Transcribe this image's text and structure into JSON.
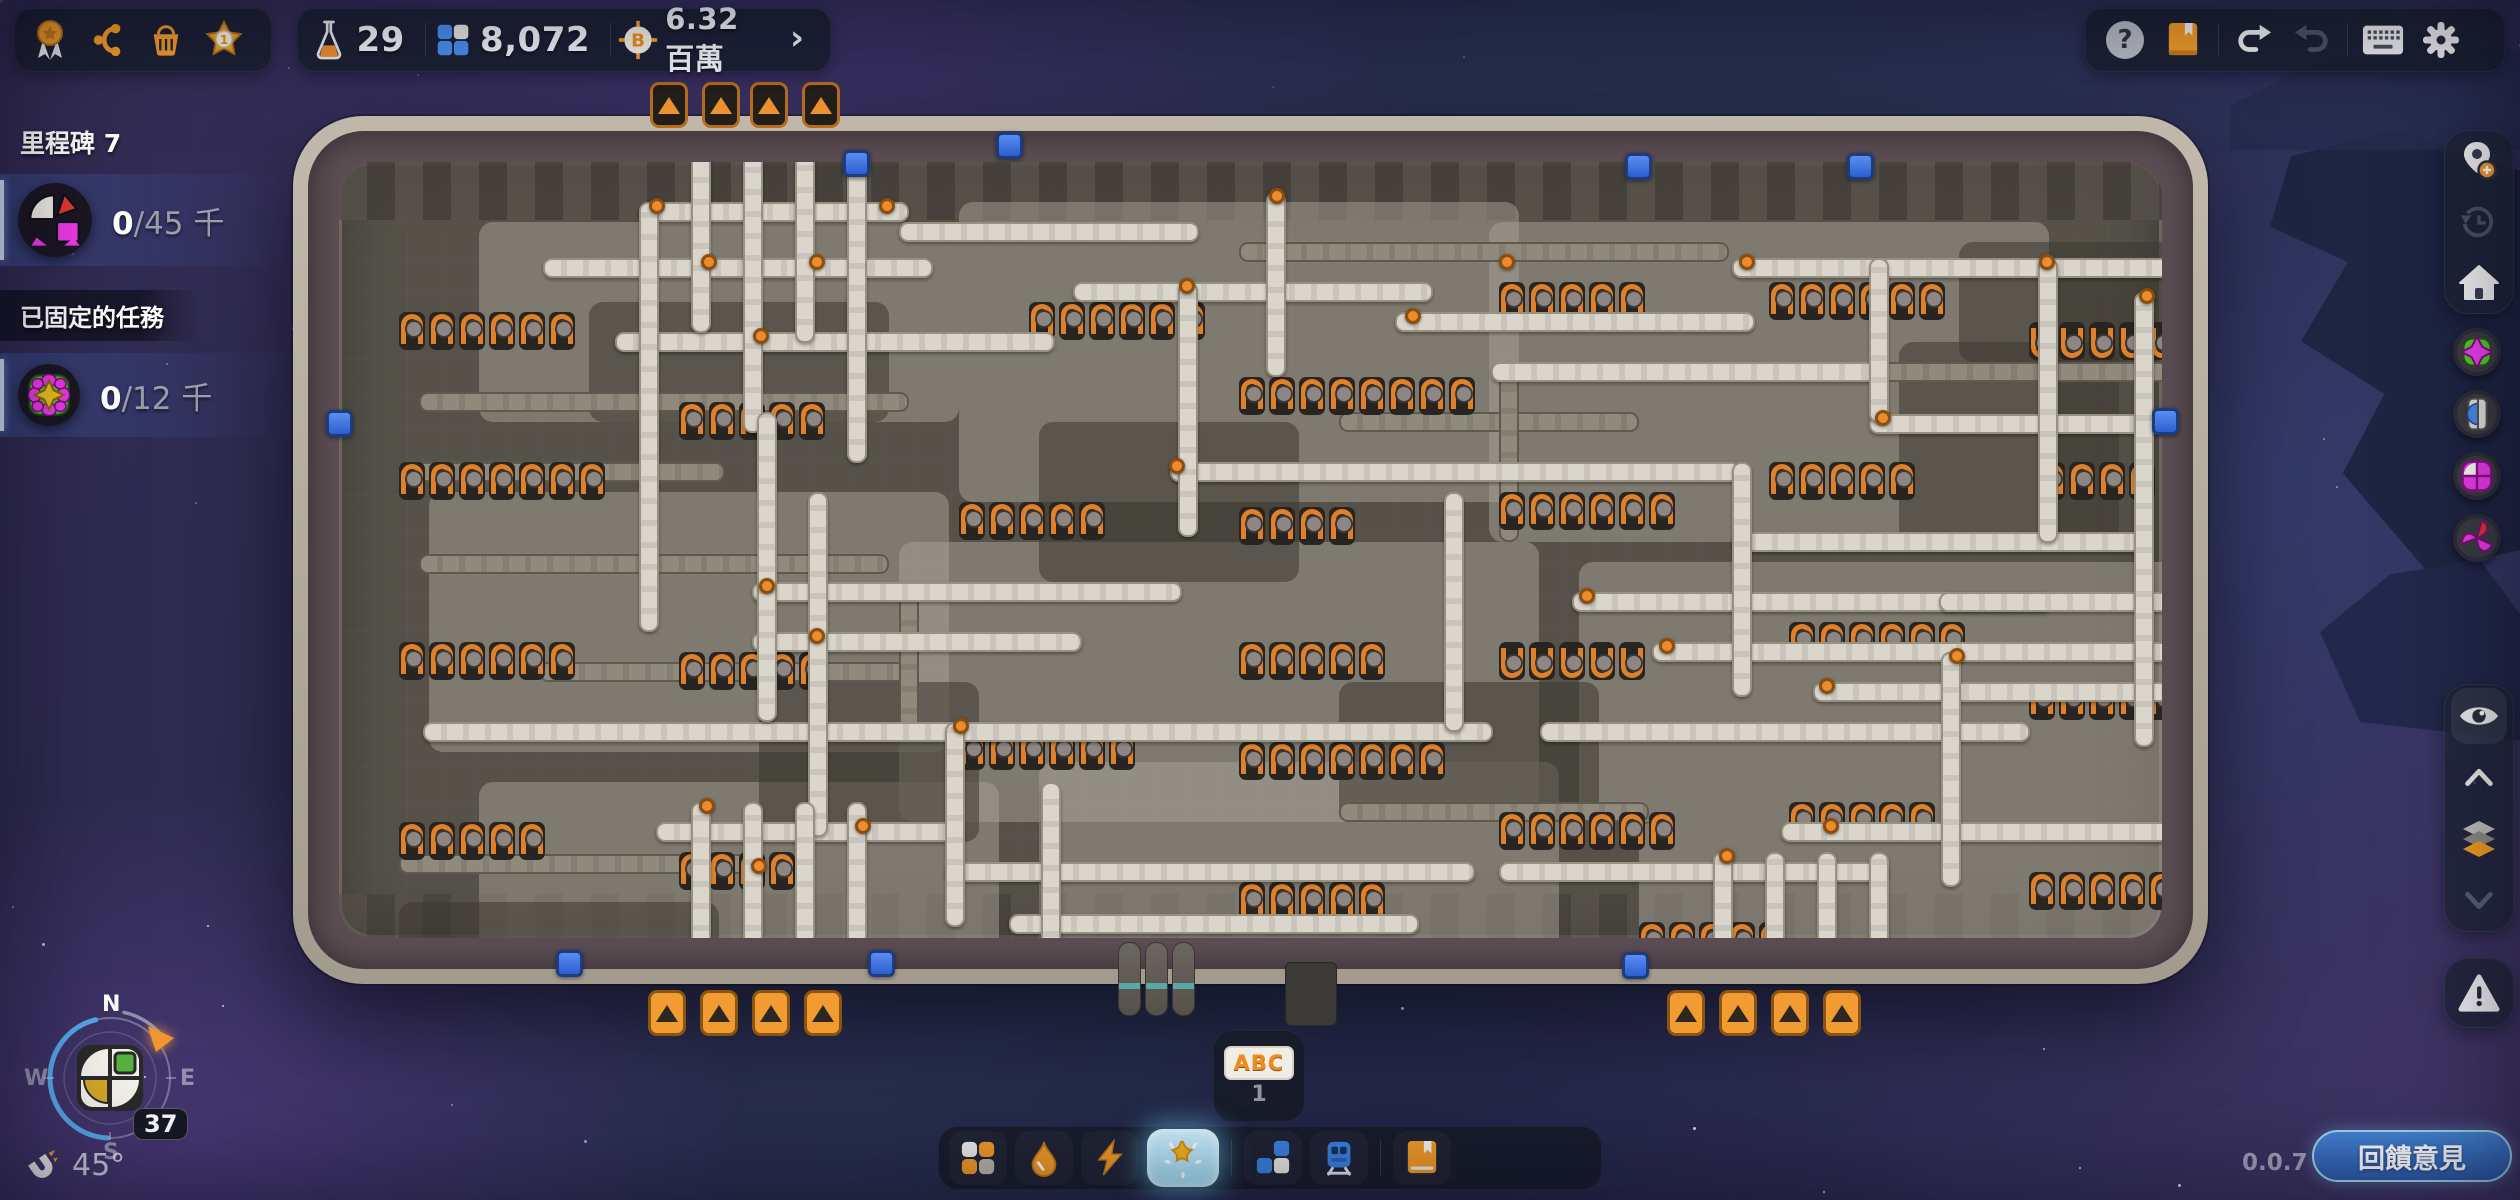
{
  "topbar": {
    "left_menu_icons": [
      "medal-icon",
      "milestones-curve-icon",
      "shop-basket-icon",
      "level-star-icon"
    ],
    "resources": {
      "research_points": "29",
      "stored_shapes": "8,072",
      "currency": "6.32 百萬",
      "expand_chevron": "›"
    },
    "system_icons": [
      "help-icon",
      "wiki-book-icon",
      "undo-icon",
      "redo-icon",
      "keyboard-icon",
      "settings-gear-icon"
    ]
  },
  "left_panel": {
    "milestone_title": "里程碑 7",
    "milestone": {
      "progress": "0",
      "goal": "/45 千"
    },
    "pinned_title": "已固定的任務",
    "pinned_task": {
      "progress": "0",
      "goal": "/12 千"
    }
  },
  "right_sidebar": {
    "icons": [
      "waypoint-add-icon",
      "history-icon",
      "home-icon",
      "shape-badge-pin-green",
      "shape-badge-half-blue",
      "shape-badge-windows-magenta",
      "shape-badge-pinwheel",
      "eye-icon",
      "layer-up-icon",
      "layers-icon",
      "layer-down-icon",
      "warning-icon"
    ]
  },
  "compass": {
    "north": "N",
    "east": "E",
    "south": "S",
    "west": "W",
    "level_badge": "37",
    "angle": "45°"
  },
  "hotbar_slot": {
    "label": "ABC",
    "slot_number": "1"
  },
  "toolbar": {
    "tools": [
      "shapes-tool-icon",
      "fluids-tool-icon",
      "power-tool-icon",
      "star-tool-icon",
      "platforms-tool-icon",
      "trains-tool-icon",
      "wiki-tool-icon"
    ],
    "selected_tool": "star-tool-icon"
  },
  "footer": {
    "version": "0.0.7",
    "feedback_button": "回饋意見"
  }
}
